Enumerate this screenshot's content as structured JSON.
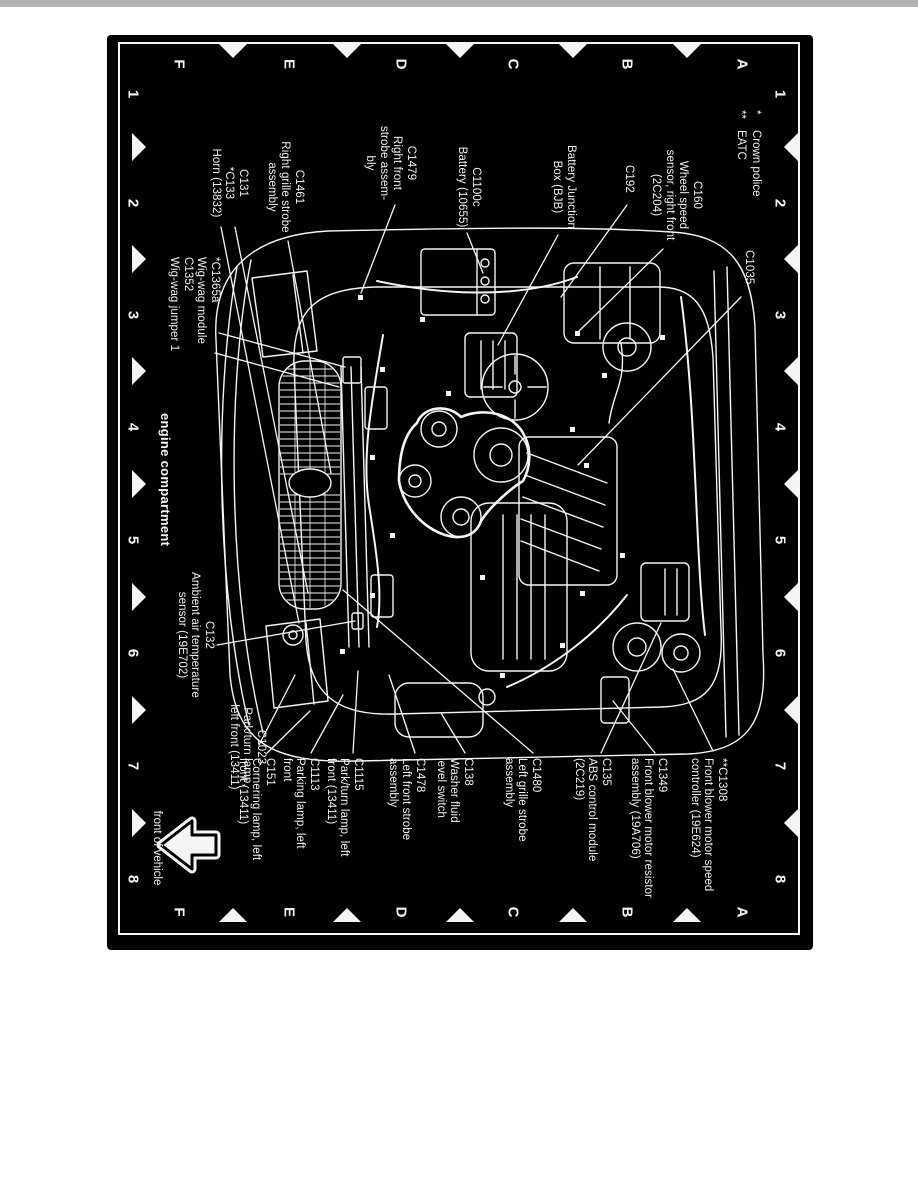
{
  "figure": {
    "caption": "engine compartment",
    "front_of_vehicle": "front of vehicle",
    "colors": {
      "page": "#ffffff",
      "background": "#020202",
      "ink": "#f5f5f5"
    },
    "legend": [
      {
        "symbol": "*",
        "text": "Crown police"
      },
      {
        "symbol": "**",
        "text": "EATC"
      }
    ],
    "grid": {
      "row_letters": [
        "A",
        "B",
        "C",
        "D",
        "E",
        "F"
      ],
      "column_numbers": [
        "1",
        "2",
        "3",
        "4",
        "5",
        "6",
        "7",
        "8"
      ]
    },
    "labels": {
      "left": [
        {
          "id": "c1035",
          "lines": [
            "C1035"
          ]
        },
        {
          "id": "c160",
          "lines": [
            "C160",
            "Wheel speed",
            "sensor, right front",
            "(2C204)"
          ]
        },
        {
          "id": "c192",
          "lines": [
            "C192"
          ]
        },
        {
          "id": "bjb",
          "lines": [
            "Battery Junction",
            "Box (BJB)"
          ]
        },
        {
          "id": "c1100c",
          "lines": [
            "C1100c",
            "Battery (10655)"
          ]
        },
        {
          "id": "c1479",
          "lines": [
            "C1479",
            "Right front",
            "strobe assem-",
            "bly"
          ]
        },
        {
          "id": "c1461",
          "lines": [
            "C1461",
            "Right grille strobe",
            "assembly"
          ]
        },
        {
          "id": "c131",
          "lines": [
            "C131",
            "*C133",
            "Horn (13832)"
          ]
        }
      ],
      "right": [
        {
          "id": "c1308",
          "lines": [
            "**C1308",
            "Front blower motor speed",
            "controller (19E624)"
          ]
        },
        {
          "id": "c1349",
          "lines": [
            "C1349",
            "Front blower motor resistor",
            "assembly (19A706)"
          ]
        },
        {
          "id": "c135",
          "lines": [
            "C135",
            "ABS control module",
            "(2C219)"
          ]
        },
        {
          "id": "c1480",
          "lines": [
            "C1480",
            "Left grille strobe",
            "assembly"
          ]
        },
        {
          "id": "c138",
          "lines": [
            "C138",
            "Washer fluid",
            "level switch"
          ]
        },
        {
          "id": "c1478",
          "lines": [
            "C1478",
            "Left front strobe",
            "assembly"
          ]
        },
        {
          "id": "c1115",
          "lines": [
            "C1115",
            "Park/turn lamp, left",
            "front (13411)"
          ]
        },
        {
          "id": "c1113",
          "lines": [
            "C1113",
            "Parking lamp, left",
            "front"
          ]
        },
        {
          "id": "c151",
          "lines": [
            "C151",
            "Cornering lamp, left",
            "front (13411)"
          ]
        }
      ],
      "bottom": [
        {
          "id": "wigwag",
          "lines": [
            "*C1365a",
            "Wig-wag module",
            "C1352",
            "Wig-wag jumper 1"
          ]
        },
        {
          "id": "c132",
          "lines": [
            "C132",
            "Ambient air temperature",
            "sensor (19E702)"
          ]
        },
        {
          "id": "c1023",
          "lines": [
            "C1023",
            "Park/turn lamp,",
            "left front (13411)"
          ]
        }
      ]
    }
  }
}
